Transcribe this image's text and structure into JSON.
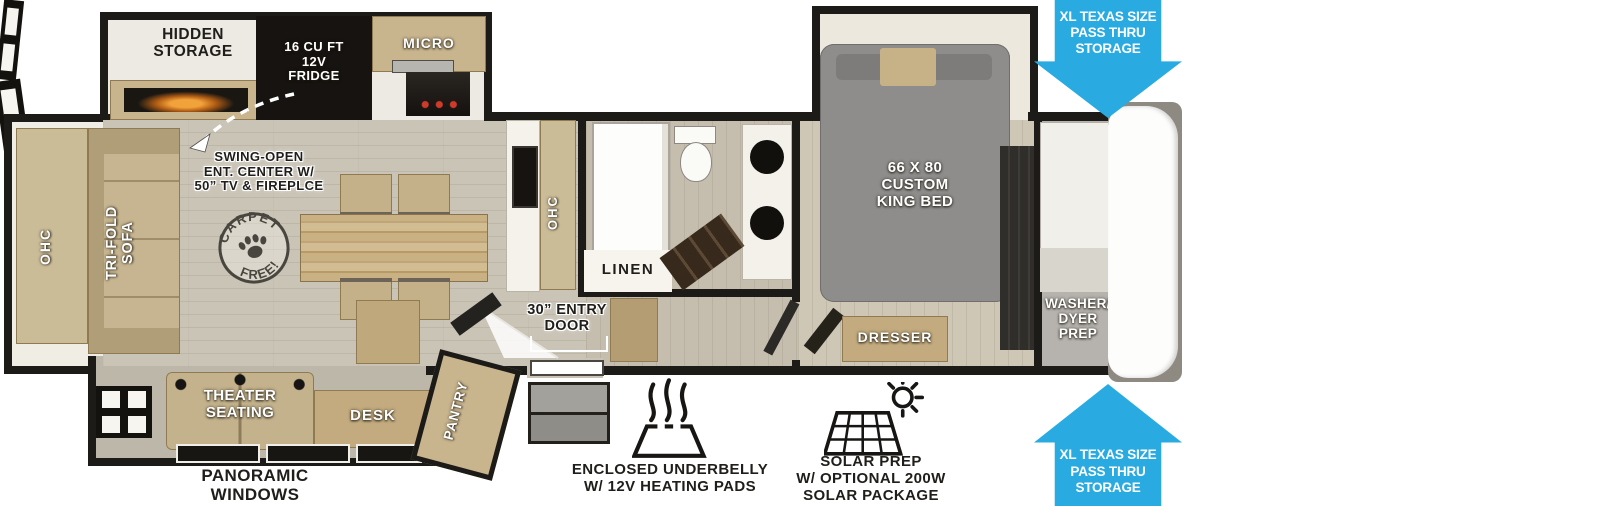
{
  "colors": {
    "arrow_blue": "#29abe2",
    "wall_black": "#1d1b18",
    "floor_tan": "#cac4b7",
    "cabinet_tan": "#c8b48d",
    "bed_gray": "#8e8d8b",
    "slide_white": "#efece4"
  },
  "kitchen": {
    "hidden_storage_label": "HIDDEN\nSTORAGE",
    "fridge_label": "16 CU FT\n12V\nFRIDGE",
    "micro_label": "MICRO",
    "ohc_label": "OHC"
  },
  "living": {
    "rear_ohc_label": "OHC",
    "sofa_label": "TRI-FOLD\nSOFA",
    "ent_center_label": "SWING-OPEN\nENT. CENTER W/\n50” TV & FIREPLCE",
    "carpet_stamp": {
      "top": "CARPET",
      "bottom": "FREE!"
    }
  },
  "bathroom": {
    "linen_label": "LINEN"
  },
  "entry": {
    "door_label": "30” ENTRY\nDOOR"
  },
  "bedroom": {
    "bed_label": "66 X 80\nCUSTOM\nKING BED",
    "dresser_label": "DRESSER",
    "washer_label": "WASHER/\nDYER\nPREP"
  },
  "den": {
    "theater_label": "THEATER\nSEATING",
    "desk_label": "DESK",
    "pantry_label": "PANTRY"
  },
  "callouts": {
    "pass_thru": "XL TEXAS SIZE\nPASS THRU\nSTORAGE",
    "panoramic": "PANORAMIC\nWINDOWS",
    "underbelly": "ENCLOSED UNDERBELLY\nW/ 12V HEATING PADS",
    "solar": "SOLAR PREP\nW/ OPTIONAL 200W\nSOLAR PACKAGE"
  }
}
